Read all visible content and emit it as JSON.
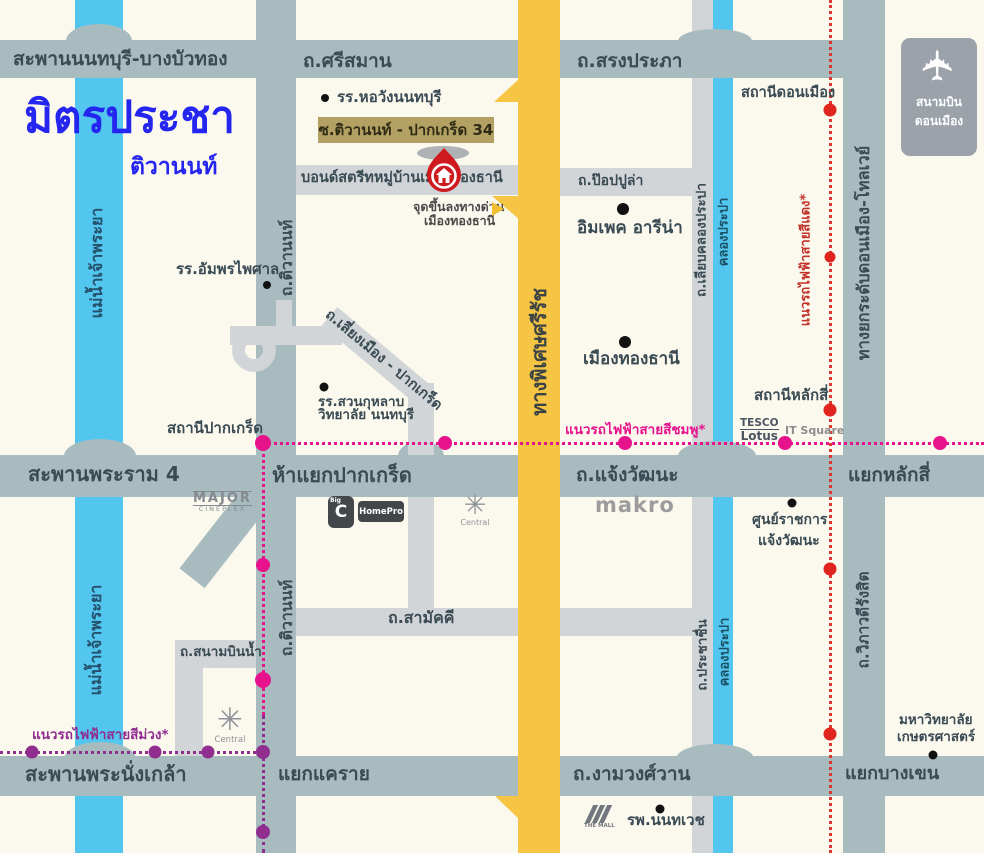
{
  "title": {
    "main": "มิตรประชา",
    "sub": "ติวานนท์"
  },
  "roads": {
    "bridge_nonthaburi": "สะพานนนทบุรี-บางบัวทอง",
    "srisaman": "ถ.ศรีสมาน",
    "songprapa": "ถ.สรงประภา",
    "bond_street": "บอนด์สตรีทหมู่บ้านเมืองทองธานี",
    "popular": "ถ.ป๊อปปูล่า",
    "tiwanon": "ถ.ติวานนท์",
    "sirat_expressway": "ทางพิเศษศรีรัช",
    "liab_klong_prapa": "ถ.เลียบคลองประปา",
    "prachachuen": "ถ.ประชาชื่น",
    "tollway": "ทางยกระดับดอนเมือง-โทลเวย์",
    "vibhavadi": "ถ.วิภาวดีรังสิต",
    "liang_muang": "ถ.เลี่ยงเมือง - ปากเกร็ด",
    "rama4_bridge": "สะพานพระราม 4",
    "chaengwattana": "ถ.แจ้งวัฒนะ",
    "samakkhi": "ถ.สามัคคี",
    "sanambin_nam": "ถ.สนามบินน้ำ",
    "phranangklao_bridge": "สะพานพระนั่งเกล้า",
    "ngamwongwan": "ถ.งามวงศ์วาน"
  },
  "waterways": {
    "chao_phraya": "แม่น้ำเจ้าพระยา",
    "klong_prapa": "คลองประปา"
  },
  "junctions": {
    "ha_yaek_pakkret": "ห้าแยกปากเกร็ด",
    "yaek_laksi": "แยกหลักสี่",
    "yaek_khae_rai": "แยกแคราย",
    "yaek_bangkhen": "แยกบางเขน"
  },
  "transit": {
    "pink_line": "แนวรถไฟฟ้าสายสีชมพู*",
    "purple_line": "แนวรถไฟฟ้าสายสีม่วง*",
    "red_line": "แนวรถไฟฟ้าสายสีแดง*",
    "pakkret_station": "สถานีปากเกร็ด",
    "laksi_station": "สถานีหลักสี่",
    "donmueang_station": "สถานีดอนเมือง"
  },
  "places": {
    "soi_tag": "ซ.ติวานนท์ - ปากเกร็ด 34",
    "horwang_school": "รร.หอวังนนทบุรี",
    "expressway_access_1": "จุดขึ้นลงทางด่วน",
    "expressway_access_2": "เมืองทองธานี",
    "impact_arena": "อิมเพค อารีน่า",
    "muang_thong_thani": "เมืองทองธานี",
    "amphorn_school": "รร.อัมพรไพศาล",
    "suankularb_1": "รร.สวนกุหลาบ",
    "suankularb_2": "วิทยาลัย นนทบุรี",
    "govt_center_1": "ศูนย์ราชการ",
    "govt_center_2": "แจ้งวัฒนะ",
    "it_square": "IT Square",
    "nonthavej_hospital": "รพ.นนทเวช",
    "kasetsart_1": "มหาวิทยาลัย",
    "kasetsart_2": "เกษตรศาสตร์",
    "airport_1": "สนามบิน",
    "airport_2": "ดอนเมือง"
  },
  "logos": {
    "makro": "makro",
    "tesco_1": "TESCO",
    "tesco_2": "Lotus",
    "major_1": "MAJOR",
    "major_2": "CINEPLEX",
    "bigc_small": "Big",
    "bigc": "C",
    "homepro": "HomePro",
    "central": "Central",
    "themall": "THE MALL"
  },
  "colors": {
    "background": "#FBF8EE",
    "road_main": "#A8BCBF",
    "road_light": "#D2D5D8",
    "expressway_yellow": "#F7C544",
    "water_blue": "#52C6EE",
    "title_blue": "#2525F0",
    "pink_line": "#E6138C",
    "purple_line": "#8F2E8F",
    "red_line": "#D9372F",
    "soi_tag_bg": "#B2A162",
    "pin_red": "#CE1A1F"
  }
}
